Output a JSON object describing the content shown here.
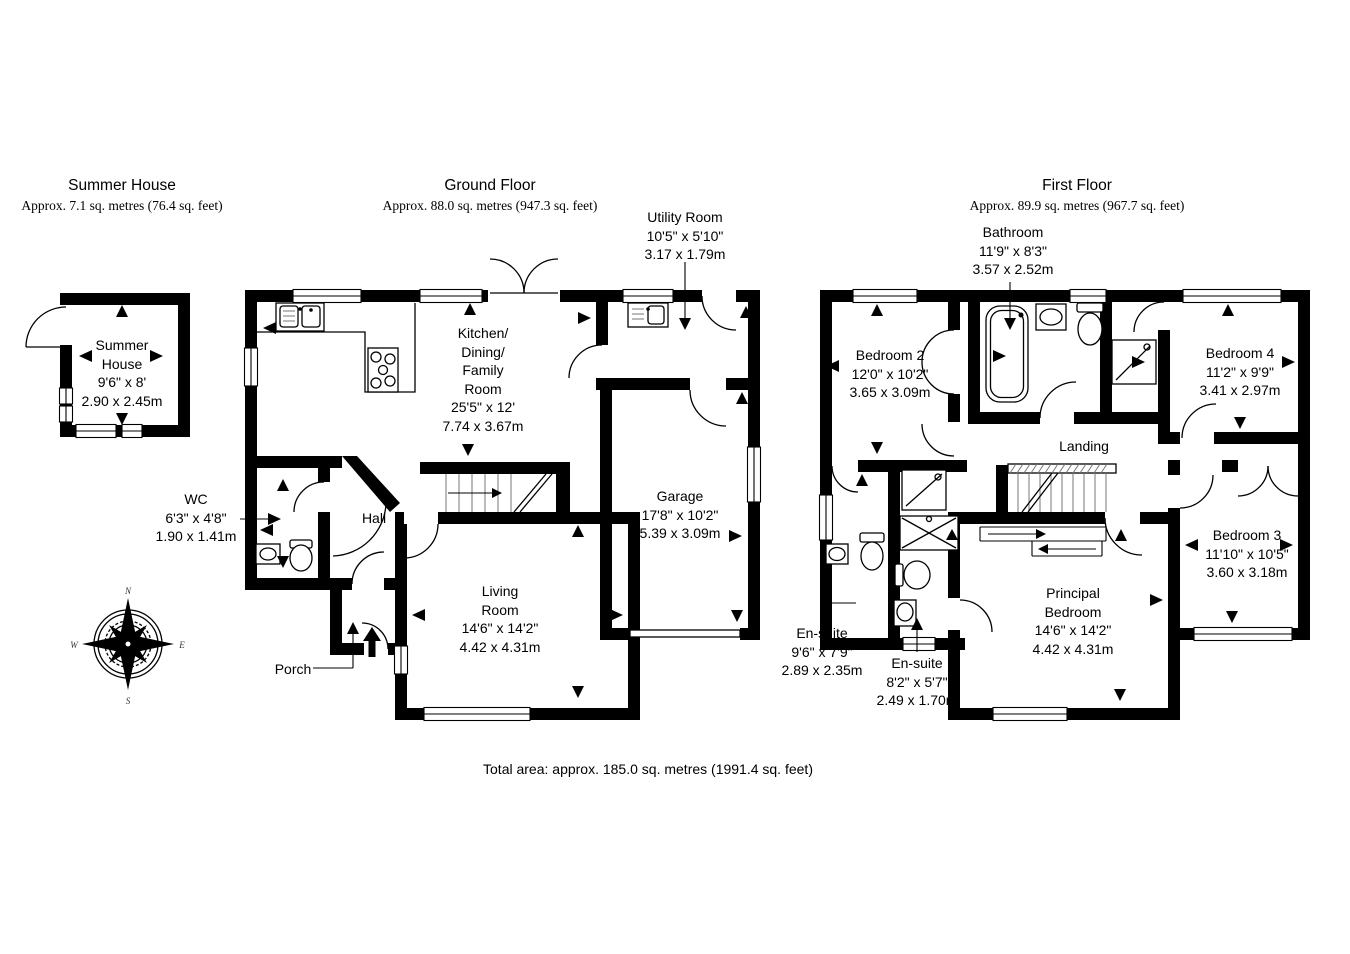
{
  "header": {
    "summer_house": {
      "title": "Summer House",
      "area": "Approx. 7.1 sq. metres (76.4 sq. feet)"
    },
    "ground_floor": {
      "title": "Ground Floor",
      "area": "Approx. 88.0 sq. metres (947.3 sq. feet)"
    },
    "first_floor": {
      "title": "First Floor",
      "area": "Approx. 89.9 sq. metres (967.7 sq. feet)"
    }
  },
  "rooms": {
    "summer_house": {
      "name": "Summer House",
      "imperial": "9'6\" x 8'",
      "metric": "2.90 x 2.45m"
    },
    "kitchen": {
      "name": "Kitchen/ Dining/ Family Room",
      "imperial": "25'5\" x 12'",
      "metric": "7.74 x 3.67m"
    },
    "utility": {
      "name": "Utility Room",
      "imperial": "10'5\" x 5'10\"",
      "metric": "3.17 x 1.79m"
    },
    "garage": {
      "name": "Garage",
      "imperial": "17'8\" x 10'2\"",
      "metric": "5.39 x 3.09m"
    },
    "wc": {
      "name": "WC",
      "imperial": "6'3\" x 4'8\"",
      "metric": "1.90 x 1.41m"
    },
    "hall": {
      "name": "Hall"
    },
    "living_room": {
      "name": "Living Room",
      "imperial": "14'6\" x 14'2\"",
      "metric": "4.42 x 4.31m"
    },
    "porch": {
      "name": "Porch"
    },
    "bedroom2": {
      "name": "Bedroom 2",
      "imperial": "12'0\" x 10'2\"",
      "metric": "3.65 x 3.09m"
    },
    "bathroom": {
      "name": "Bathroom",
      "imperial": "11'9\" x 8'3\"",
      "metric": "3.57 x 2.52m"
    },
    "bedroom4": {
      "name": "Bedroom 4",
      "imperial": "11'2\" x 9'9\"",
      "metric": "3.41 x 2.97m"
    },
    "landing": {
      "name": "Landing"
    },
    "bedroom3": {
      "name": "Bedroom 3",
      "imperial": "11'10\" x 10'5\"",
      "metric": "3.60 x 3.18m"
    },
    "principal_bedroom": {
      "name": "Principal Bedroom",
      "imperial": "14'6\" x 14'2\"",
      "metric": "4.42 x 4.31m"
    },
    "ensuite1": {
      "name": "En-suite",
      "imperial": "9'6\" x 7'9\"",
      "metric": "2.89 x 2.35m"
    },
    "ensuite2": {
      "name": "En-suite",
      "imperial": "8'2\" x 5'7\"",
      "metric": "2.49 x 1.70m"
    }
  },
  "footer": {
    "total_area": "Total area: approx. 185.0 sq. metres (1991.4 sq. feet)"
  },
  "compass": {
    "north": "N",
    "east": "E",
    "south": "S",
    "west": "W"
  }
}
